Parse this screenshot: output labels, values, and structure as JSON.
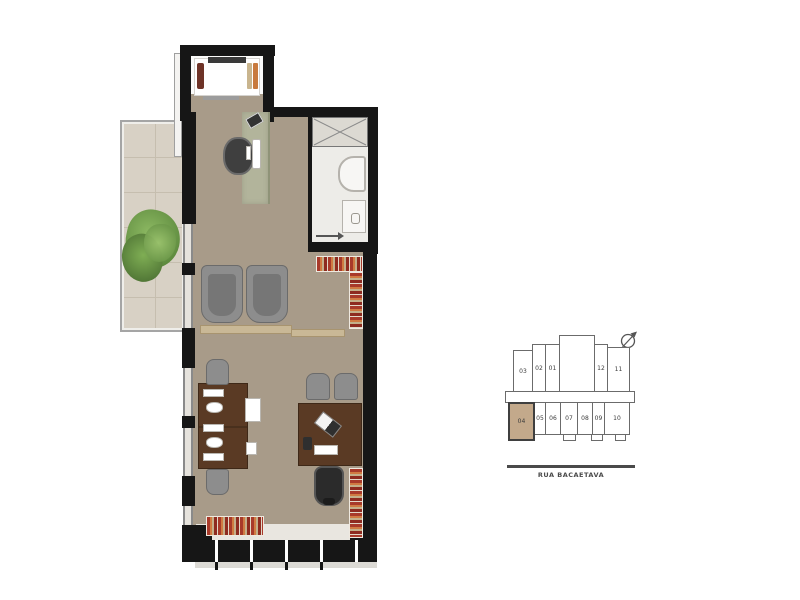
{
  "page": {
    "background": "#ffffff"
  },
  "floorplan": {
    "type": "studio-office-unit-plan",
    "palette": {
      "wall": "#161616",
      "floor_main": "#a89b89",
      "floor_terrace": "#d8d1c5",
      "floor_bath": "#edece8",
      "desk_top_green": "#b2b49b",
      "desk_wood": "#5a3a24",
      "shelf_wood": "#c9b896",
      "books_red": "#a83a2a",
      "books_orange": "#d07a42",
      "plant_green": "#6f9c49",
      "chair_gray": "#8d8d8d",
      "chair_black": "#2b2b2b"
    },
    "furniture": [
      "bed",
      "work-desk",
      "office-chair",
      "monitor",
      "laptop",
      "armchairs",
      "bookshelves",
      "team-desk",
      "printer",
      "meeting-desk",
      "guest-chairs",
      "executive-chair",
      "shower",
      "vanity",
      "closet",
      "plant",
      "terrace"
    ]
  },
  "keyplan": {
    "north_icon": "compass-north-arrow",
    "highlight_color": "#c3a98b",
    "highlighted_unit": "04",
    "units_top": [
      {
        "label": "03"
      },
      {
        "label": "02"
      },
      {
        "label": "01"
      },
      {
        "label": "12"
      },
      {
        "label": "11"
      }
    ],
    "units_bottom": [
      {
        "label": "04"
      },
      {
        "label": "05"
      },
      {
        "label": "06"
      },
      {
        "label": "07"
      },
      {
        "label": "08"
      },
      {
        "label": "09"
      },
      {
        "label": "10"
      }
    ],
    "street_label": "RUA BACAETAVA"
  }
}
